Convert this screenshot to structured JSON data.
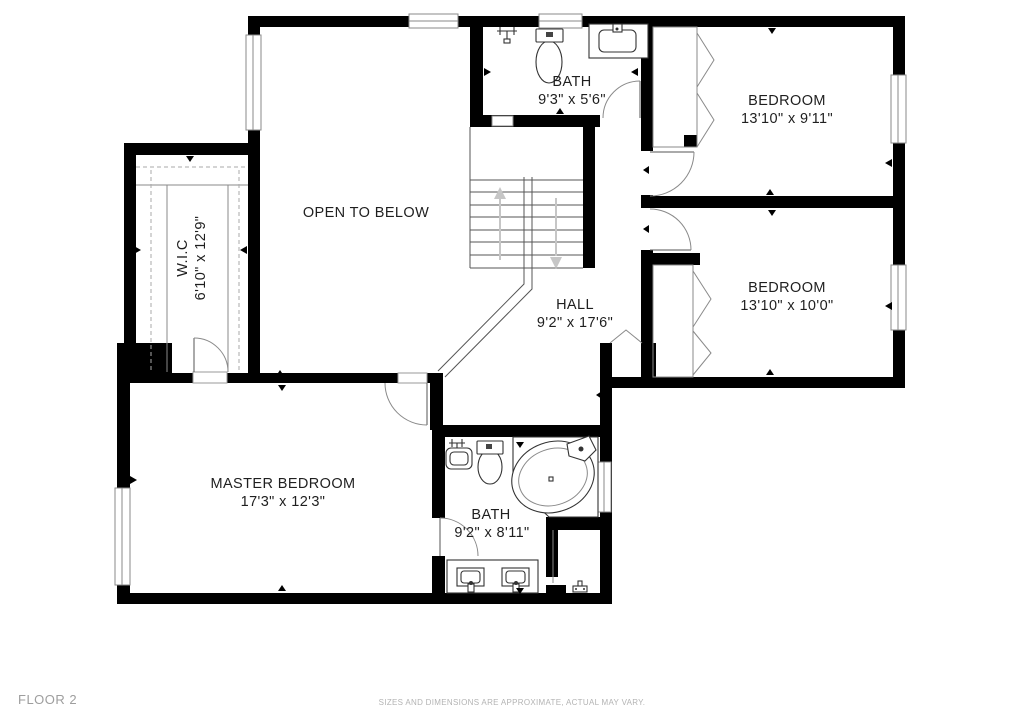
{
  "rooms": {
    "open_to_below": {
      "label": "OPEN TO BELOW"
    },
    "bath_upper": {
      "label": "BATH",
      "dims": "9'3\" x 5'6\""
    },
    "bedroom_top": {
      "label": "BEDROOM",
      "dims": "13'10\" x 9'11\""
    },
    "bedroom_mid": {
      "label": "BEDROOM",
      "dims": "13'10\" x 10'0\""
    },
    "wic": {
      "label": "W.I.C",
      "dims": "6'10\" x 12'9\""
    },
    "hall": {
      "label": "HALL",
      "dims": "9'2\" x 17'6\""
    },
    "master": {
      "label": "MASTER BEDROOM",
      "dims": "17'3\" x 12'3\""
    },
    "bath_master": {
      "label": "BATH",
      "dims": "9'2\" x 8'11\""
    }
  },
  "footer": {
    "floor_label": "FLOOR 2",
    "disclaimer": "SIZES AND DIMENSIONS ARE APPROXIMATE, ACTUAL MAY VARY."
  },
  "colors": {
    "wall": "#000000",
    "background": "#ffffff",
    "stair_arrow": "#c6c6c6",
    "footer_text": "#9e9e9e",
    "disclaimer_text": "#b3b3b3"
  }
}
